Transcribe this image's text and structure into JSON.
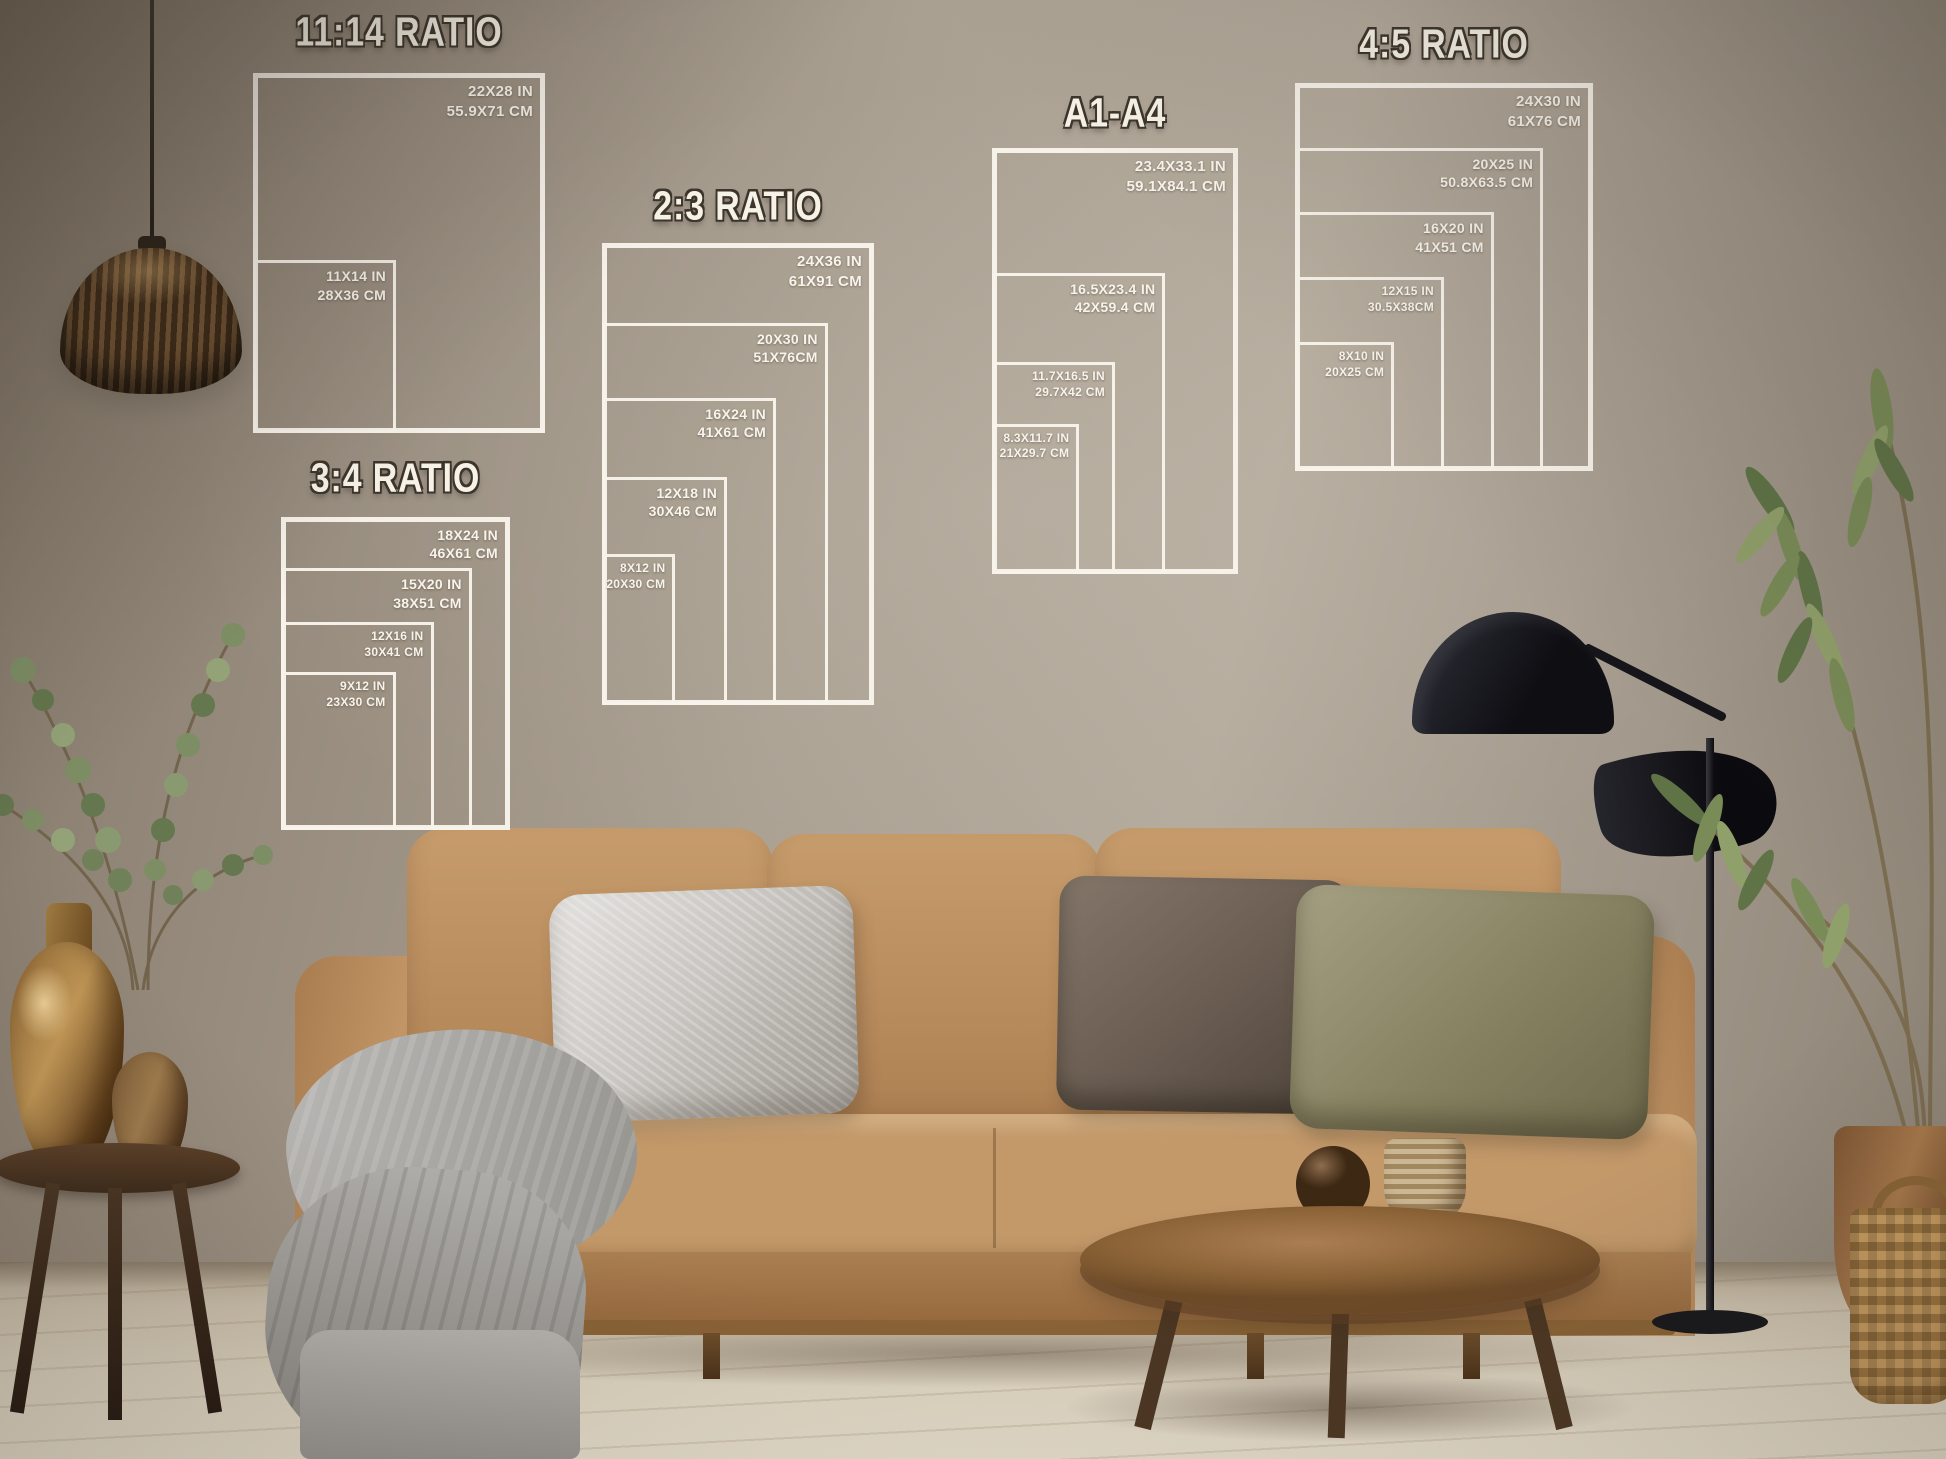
{
  "charts": [
    {
      "title": "11:14 RATIO",
      "sizes": [
        {
          "in": "22X28 IN",
          "cm": "55.9X71 CM"
        },
        {
          "in": "11X14 IN",
          "cm": "28X36 CM"
        }
      ]
    },
    {
      "title": "3:4 RATIO",
      "sizes": [
        {
          "in": "18X24 IN",
          "cm": "46X61 CM"
        },
        {
          "in": "15X20 IN",
          "cm": "38X51 CM"
        },
        {
          "in": "12X16 IN",
          "cm": "30X41 CM"
        },
        {
          "in": "9X12 IN",
          "cm": "23X30 CM"
        }
      ]
    },
    {
      "title": "2:3 RATIO",
      "sizes": [
        {
          "in": "24X36 IN",
          "cm": "61X91 CM"
        },
        {
          "in": "20X30 IN",
          "cm": "51X76CM"
        },
        {
          "in": "16X24 IN",
          "cm": "41X61 CM"
        },
        {
          "in": "12X18 IN",
          "cm": "30X46 CM"
        },
        {
          "in": "8X12 IN",
          "cm": "20X30 CM"
        }
      ]
    },
    {
      "title": "A1-A4",
      "sizes": [
        {
          "in": "23.4X33.1 IN",
          "cm": "59.1X84.1 CM"
        },
        {
          "in": "16.5X23.4 IN",
          "cm": "42X59.4 CM"
        },
        {
          "in": "11.7X16.5 IN",
          "cm": "29.7X42 CM"
        },
        {
          "in": "8.3X11.7 IN",
          "cm": "21X29.7 CM"
        }
      ]
    },
    {
      "title": "4:5 RATIO",
      "sizes": [
        {
          "in": "24X30 IN",
          "cm": "61X76 CM"
        },
        {
          "in": "20X25 IN",
          "cm": "50.8X63.5 CM"
        },
        {
          "in": "16X20 IN",
          "cm": "41X51 CM"
        },
        {
          "in": "12X15 IN",
          "cm": "30.5X38CM"
        },
        {
          "in": "8X10 IN",
          "cm": "20X25 CM"
        }
      ]
    }
  ],
  "colors": {
    "overlay_line": "#f8f4eb",
    "title_text": "#f6f2e7",
    "wall": "#a89d8f",
    "sofa": "#bd9162",
    "floor": "#ddd3c0"
  }
}
